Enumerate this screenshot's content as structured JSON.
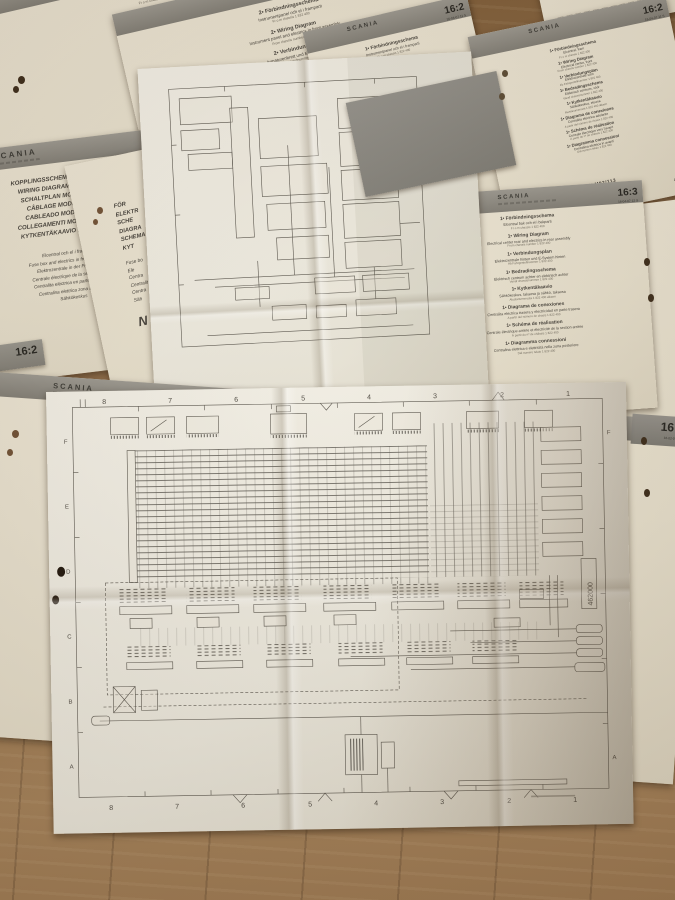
{
  "colors": {
    "wood": "#8a6845",
    "paper_cream": "#e9e2d0",
    "paper_white": "#f1eee5",
    "band_gray": "#8f8d85",
    "ink": "#44403a"
  },
  "top_strips": {
    "left": {
      "text": "NIVÅALB",
      "code": "469050  2/1"
    },
    "right": {
      "text": "NIVÅALB",
      "code": "469050  2/1"
    }
  },
  "left_edge_tab": {
    "tab": "16:2"
  },
  "sheets": {
    "a": {
      "brand": "SCANIA",
      "tab": "16:2",
      "tab_code": "16-04-07 11 S",
      "sections": [
        {
          "t": "2• Förbindningsschema",
          "s": "Elcentral, fram",
          "n": "Fr o m chassis 1 822 400"
        },
        {
          "t": "2• Wiring Diagram",
          "s": "Electrical center, front",
          "n": "From chassis number 1 822 400"
        },
        {
          "t": "2• Verbindungsplan",
          "s": "Elektrozentrale vorn",
          "n": "Ab Fahrgestellnummer 1 822 400"
        },
        {
          "t": "2• Bedradingsschema",
          "s": "Elektrisch centrum, vóór",
          "n": "Vanaf chassisnummer 1 822 400"
        },
        {
          "t": "2• Kytkentäkaavio",
          "s": "Sähkökeskus, etuosa",
          "n": "Alustanumerosta 1 822 400 alkaen"
        },
        {
          "t": "2• Diagrama de conexiones",
          "s": "Centralita eléctrica adelante",
          "n": "A partir del número de chasis 1 822 400"
        },
        {
          "t": "2• Schéma de réalisation",
          "s": "Centrale électrique vers l'avant",
          "n": "À partir du nº de châssis 1 822 400"
        },
        {
          "t": "2• Diagramma connessioni",
          "s": "Centralina elettrica in avanti",
          "n": "Dal numero telaio 1 822 400"
        }
      ],
      "footer_center": "NIVÅALB",
      "footer_right": "469050  2/1"
    },
    "b": {
      "brand": "SCANIA",
      "tab": "16:2",
      "tab_code": "16-04-07 11 S",
      "sections": [
        {
          "t": "2• Förbindningsschema",
          "s": "Instrumentpanel och el i framparti",
          "n": "Fr o m chassis 1 822 400"
        },
        {
          "t": "2• Wiring Diagram",
          "s": "Instrument panel and electrics in front assembly",
          "n": "From chassis number 1 822 400"
        },
        {
          "t": "2• Verbindungsplan",
          "s": "Armaturenbrett und E-System vorn",
          "n": "Ab Fahrgestellnummer 1 822 400"
        },
        {
          "t": "2• Bedradingsschema",
          "s": "Instrumentenpaneel en elektrisch vóór",
          "n": "Vanaf chassisnummer 1 822 400"
        },
        {
          "t": "2• Kytkentäkaavio",
          "s": "Kojetaulu ja etuosan sähkö",
          "n": "Alustanumerosta 1 822 400 alkaen"
        }
      ]
    },
    "c": {
      "brand": "SCANIA",
      "tab": "16:2",
      "tab_code": "16-04-07 11 S",
      "sections": [
        {
          "t": "1• Förbindningsschema",
          "s": "Instrumentpanel och el i framparti",
          "n": "Fr o m chassis 1 822 400"
        },
        {
          "t": "1• Wiring Diagram",
          "s": "Instrument panel and electrics in front assembly",
          "n": "From chassis number 1 822 400"
        },
        {
          "t": "1• Verbindungsplan",
          "s": "Armaturenbrett und E-System vorn",
          "n": "Ab Fahrgestellnummer 1 822 400"
        },
        {
          "t": "1• Bedradingsschema",
          "s": "Instrumentenpaneel en elektrisch vóór",
          "n": "Vanaf chassisnummer 1 822 400"
        },
        {
          "t": "1• Kytkentäkaavio",
          "s": "Kojetaulu ja etuosan sähkö",
          "n": "Alustanumerosta 1 822 400 alkaen"
        }
      ]
    },
    "d": {
      "brand": "SCANIA",
      "tab": "16:2",
      "tab_code": "16-04-07 11 S",
      "sections": [
        {
          "t": "1• Förbindningsschema",
          "s": "Elcentral, fram",
          "n": "Fr o m chassis 1 822 400"
        },
        {
          "t": "1• Wiring Diagram",
          "s": "Electrical center, front",
          "n": "From chassis number 1 822 400"
        },
        {
          "t": "1• Verbindungsplan",
          "s": "Elektrozentrale vorn",
          "n": "Ab Fahrgestellnummer 1 822 400"
        },
        {
          "t": "1• Bedradingsschema",
          "s": "Elektrisch centrum, vóór",
          "n": "Vanaf chassisnummer 1 822 400"
        },
        {
          "t": "1• Kytkentäkaavio",
          "s": "Sähkökeskus, etuosa",
          "n": "Alustanumerosta 1 822 400 alkaen"
        },
        {
          "t": "1• Diagrama de conexiones",
          "s": "Centralita eléctrica adelante",
          "n": "A partir del número de chasis 1 822 400"
        },
        {
          "t": "1• Schéma de réalisation",
          "s": "Centrale électrique vers l'avant",
          "n": "À partir du nº de châssis 1 822 400"
        },
        {
          "t": "1• Diagramma connessioni",
          "s": "Centralina elettrica in avanti",
          "n": "Dal numero telaio 1 822 400"
        }
      ],
      "footer_center": "KLM93/113",
      "footer_right": "469050  2/3"
    },
    "e": {
      "brand": "SCANIA",
      "tab": "16:3",
      "tab_code": "16-04-07 12 S",
      "sections": [
        {
          "t": "1• Förbindningsschema",
          "s": "Elcentral bak och el i bakparti",
          "n": "Fr o m chassis 1 822 400"
        },
        {
          "t": "1• Wiring Diagram",
          "s": "Electrical center rear and electrics in rear assembly",
          "n": "From chassis number 1 822 400"
        },
        {
          "t": "1• Verbindungsplan",
          "s": "Elektrozentrale hinten und E-System hinten",
          "n": "Ab Fahrgestellnummer 1 822 400"
        },
        {
          "t": "1• Bedradingsschema",
          "s": "Elektrisch centrum achter en elektrisch achter",
          "n": "Vanaf chassisnummer 1 822 400"
        },
        {
          "t": "1• Kytkentäkaavio",
          "s": "Sähkökeskus, takaosa ja sähkö, takaosa",
          "n": "Alustanumerosta 1 822 400 alkaen"
        },
        {
          "t": "1• Diagrama de conexiones",
          "s": "Centralita eléctrica trasera y electricidad en parte trasera",
          "n": "A partir del número de chasis 1 822 400"
        },
        {
          "t": "1• Schéma de réalisation",
          "s": "Centrale électrique arrière et électricité de la section arrière",
          "n": "À partir du nº de châssis 1 822 400"
        },
        {
          "t": "1• Diagramma connessioni",
          "s": "Centralina elettrica e elettricità nella zona posteriore",
          "n": "Dal numero telaio 1 822 400"
        }
      ],
      "footer_center": "KLM93/113"
    },
    "f": {
      "brand": "SCANIA",
      "tab": "16:2",
      "tab_code": "16-04-07 11 S",
      "titles": [
        "KOPPLINGSSCHEMA MODELL -91",
        "WIRING DIAGRAM MODEL ’91",
        "SCHALTPLAN MODELL 1991",
        "CÂBLAGE MODÈLE 1991",
        "CABLEADO MODELO 1991",
        "COLLEGAMENTI MODELLO 1991",
        "KYTKENTÄKAAVIO MALLI 1991"
      ],
      "subjects": [
        "Elcentral och el i framparti",
        "Fuse box and electrics in front assembly",
        "Elektrozentrale in der Frontpartie",
        "Centrale électrique de la section avant",
        "Centralita eléctrica en parte delantera",
        "Centralina elettrica zona anteriore",
        "Sähkökeskus"
      ],
      "footer": "461000  1/3"
    },
    "g": {
      "lines1": [
        "FÖR",
        "ELEKTR",
        "SCHE",
        "DIAGRA",
        "SCHEMA",
        "KYT"
      ],
      "lines2": [
        "Fuse bo",
        "Ele",
        "Centra",
        "Centralit",
        "Centra",
        "Säh"
      ],
      "code": "N 1"
    },
    "h": {
      "brand": "SCANIA",
      "tab": "16:2",
      "tab_code": "16-02-07 12 N",
      "lines1": [
        "FÖR",
        "V",
        "ELEKTRI",
        "SCHE",
        "DIAGRA",
        "SCHEMA",
        "KYT"
      ],
      "lines2": [
        "Electric w",
        "Elektrisch",
        "Câblage é",
        "Conexiones",
        "Collegame",
        "Nivela"
      ],
      "code": "N1"
    }
  },
  "big_diagram": {
    "grid_cols": [
      "8",
      "7",
      "6",
      "5",
      "4",
      "3",
      "2",
      "1"
    ],
    "grid_rows": [
      "F",
      "E",
      "D",
      "C",
      "B",
      "A"
    ],
    "doc_number": "462000"
  }
}
